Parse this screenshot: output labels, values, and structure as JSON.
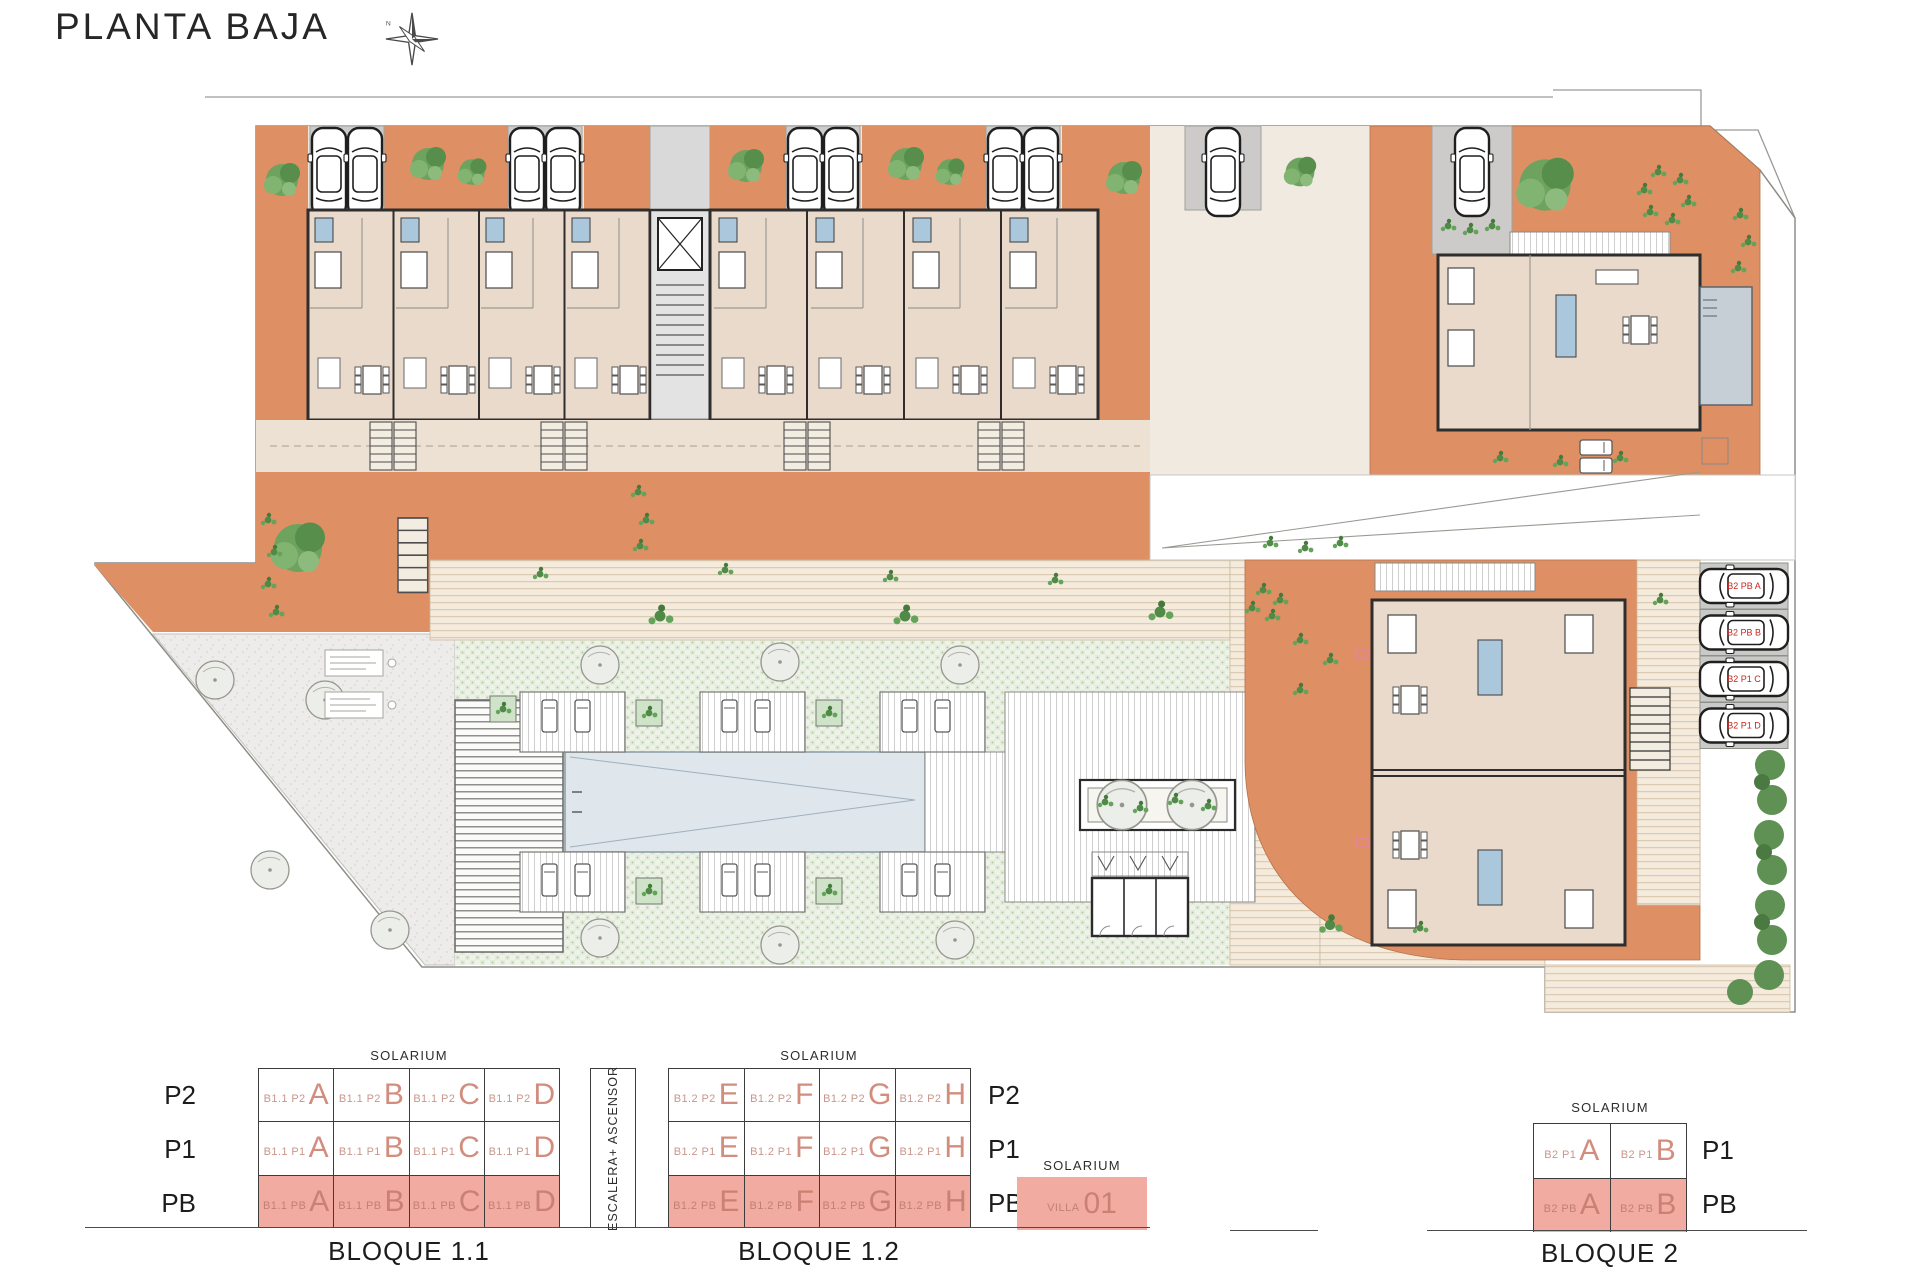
{
  "header": {
    "title": "PLANTA BAJA",
    "compass_north": "N"
  },
  "colors": {
    "terrace_orange": "#de8f63",
    "floor_beige": "#e9dacb",
    "parking_grey": "#cccbc9",
    "bath_blue": "#aac7db",
    "lawn_green": "#eef2e8",
    "pool_blue": "#dfe6ec",
    "legend_pink": "#f2aba0",
    "legend_salmon_text": "#d28d7e",
    "parking_label_red": "#c4271f",
    "wall_dark": "#2e2e2e"
  },
  "plan": {
    "parking_labels": [
      "B2 PB A",
      "B2 PB B",
      "B2 P1 C",
      "B2 P1 D"
    ]
  },
  "legend": {
    "escalera_label": "ESCALERA+ ASCENSOR",
    "bloque11": {
      "title": "BLOQUE 1.1",
      "solarium": "SOLARIUM",
      "rows": [
        {
          "label": "P2",
          "cells": [
            {
              "prefix": "B1.1 P2",
              "letter": "A"
            },
            {
              "prefix": "B1.1 P2",
              "letter": "B"
            },
            {
              "prefix": "B1.1 P2",
              "letter": "C"
            },
            {
              "prefix": "B1.1 P2",
              "letter": "D"
            }
          ]
        },
        {
          "label": "P1",
          "cells": [
            {
              "prefix": "B1.1 P1",
              "letter": "A"
            },
            {
              "prefix": "B1.1 P1",
              "letter": "B"
            },
            {
              "prefix": "B1.1 P1",
              "letter": "C"
            },
            {
              "prefix": "B1.1 P1",
              "letter": "D"
            }
          ]
        },
        {
          "label": "PB",
          "cells": [
            {
              "prefix": "B1.1 PB",
              "letter": "A"
            },
            {
              "prefix": "B1.1 PB",
              "letter": "B"
            },
            {
              "prefix": "B1.1 PB",
              "letter": "C"
            },
            {
              "prefix": "B1.1 PB",
              "letter": "D"
            }
          ]
        }
      ]
    },
    "bloque12": {
      "title": "BLOQUE 1.2",
      "solarium": "SOLARIUM",
      "rows": [
        {
          "label": "P2",
          "cells": [
            {
              "prefix": "B1.2 P2",
              "letter": "E"
            },
            {
              "prefix": "B1.2 P2",
              "letter": "F"
            },
            {
              "prefix": "B1.2 P2",
              "letter": "G"
            },
            {
              "prefix": "B1.2 P2",
              "letter": "H"
            }
          ]
        },
        {
          "label": "P1",
          "cells": [
            {
              "prefix": "B1.2 P1",
              "letter": "E"
            },
            {
              "prefix": "B1.2 P1",
              "letter": "F"
            },
            {
              "prefix": "B1.2 P1",
              "letter": "G"
            },
            {
              "prefix": "B1.2 P1",
              "letter": "H"
            }
          ]
        },
        {
          "label": "PB",
          "cells": [
            {
              "prefix": "B1.2 PB",
              "letter": "E"
            },
            {
              "prefix": "B1.2 PB",
              "letter": "F"
            },
            {
              "prefix": "B1.2 PB",
              "letter": "G"
            },
            {
              "prefix": "B1.2 PB",
              "letter": "H"
            }
          ]
        }
      ]
    },
    "villa": {
      "solarium": "SOLARIUM",
      "prefix": "VILLA",
      "number": "01"
    },
    "bloque2": {
      "title": "BLOQUE 2",
      "solarium": "SOLARIUM",
      "rows": [
        {
          "label": "P1",
          "cells": [
            {
              "prefix": "B2 P1",
              "letter": "A"
            },
            {
              "prefix": "B2 P1",
              "letter": "B"
            }
          ]
        },
        {
          "label": "PB",
          "cells": [
            {
              "prefix": "B2 PB",
              "letter": "A"
            },
            {
              "prefix": "B2 PB",
              "letter": "B"
            }
          ]
        }
      ]
    }
  }
}
